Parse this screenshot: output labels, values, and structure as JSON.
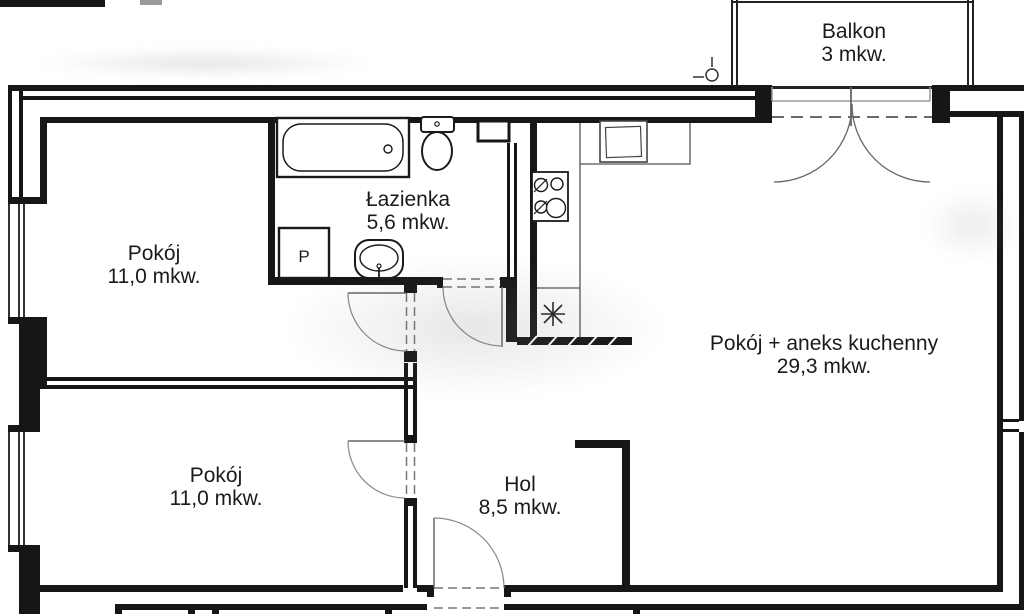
{
  "plan": {
    "background": "#ffffff",
    "line_color": "#161616",
    "rooms": [
      {
        "id": "balkon",
        "name": "Balkon",
        "area": "3 mkw."
      },
      {
        "id": "lazienka",
        "name": "Łazienka",
        "area": "5,6 mkw."
      },
      {
        "id": "pokoj-gorny",
        "name": "Pokój",
        "area": "11,0 mkw."
      },
      {
        "id": "pokoj-aneks",
        "name": "Pokój + aneks kuchenny",
        "area": "29,3 mkw."
      },
      {
        "id": "pokoj-dolny",
        "name": "Pokój",
        "area": "11,0 mkw."
      },
      {
        "id": "hol",
        "name": "Hol",
        "area": "8,5 mkw."
      }
    ],
    "labels": {
      "washing_machine": "P"
    }
  }
}
